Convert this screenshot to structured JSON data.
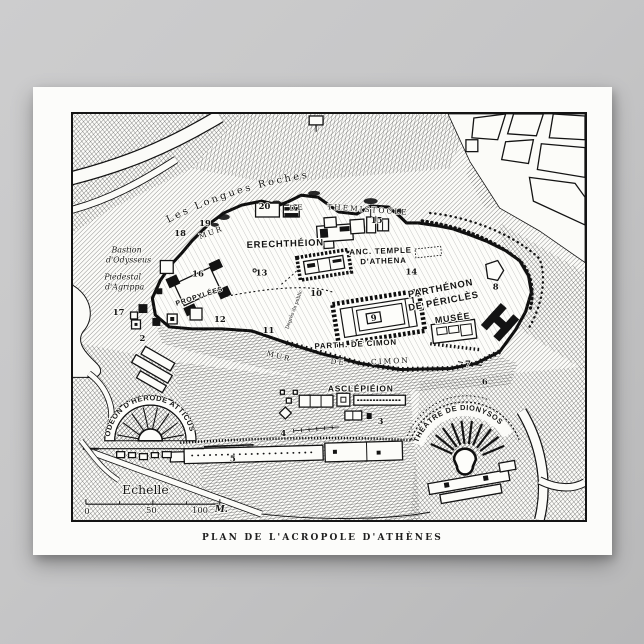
{
  "poster": {
    "caption": "PLAN DE L'ACROPOLE D'ATHÈNES"
  },
  "map": {
    "region_labels": {
      "longues_roches": "Les Longues Roches",
      "erechtheion": "ERECHTHÉION",
      "anc_temple_line1": "ANC. TEMPLE",
      "anc_temple_line2": "D'ATHENA",
      "parthenon_line1": "PARTHÉNON",
      "parthenon_line2": "DE PÉRICLÈS",
      "musee": "MUSÉE",
      "parth_de_cimon": "PARTH. DE CIMON",
      "asclepieion": "ASCLÉPIÉION",
      "theatre_dionysos": "THÉÂTRE DE DIONYSOS",
      "odeon_herode": "ODÉON D'HÉRODE ATTICUS",
      "bastion_line1": "Bastion",
      "bastion_line2": "d'Odysseus",
      "piedestal_line1": "Piédestal",
      "piedestal_line2": "d'Agrippa",
      "propylees": "PROPYLÉES",
      "degres": "Degrés du public"
    },
    "wall_labels": {
      "mur_nord": "MUR",
      "de_nord": "DE",
      "themistocle": "THÉMISTOCLE",
      "mur_sud": "MUR",
      "de_sud": "DE",
      "cimon": "CIMON"
    },
    "site_numbers": {
      "n2": "2",
      "n3": "3",
      "n4": "4",
      "n5": "5",
      "n6": "6",
      "n7": "7",
      "n8": "8",
      "n9": "9",
      "n10": "10",
      "n11": "11",
      "n12": "12",
      "n13": "13",
      "n14": "14",
      "n15": "15",
      "n16": "16",
      "n17": "17",
      "n18": "18",
      "n19": "19",
      "n20": "20"
    },
    "scale": {
      "title": "Echelle",
      "t0": "0",
      "t50": "50",
      "t100": "100",
      "unit": "M."
    }
  },
  "colors": {
    "background": "#c6c6c7",
    "paper": "#fbfbf8",
    "ink": "#141414"
  }
}
